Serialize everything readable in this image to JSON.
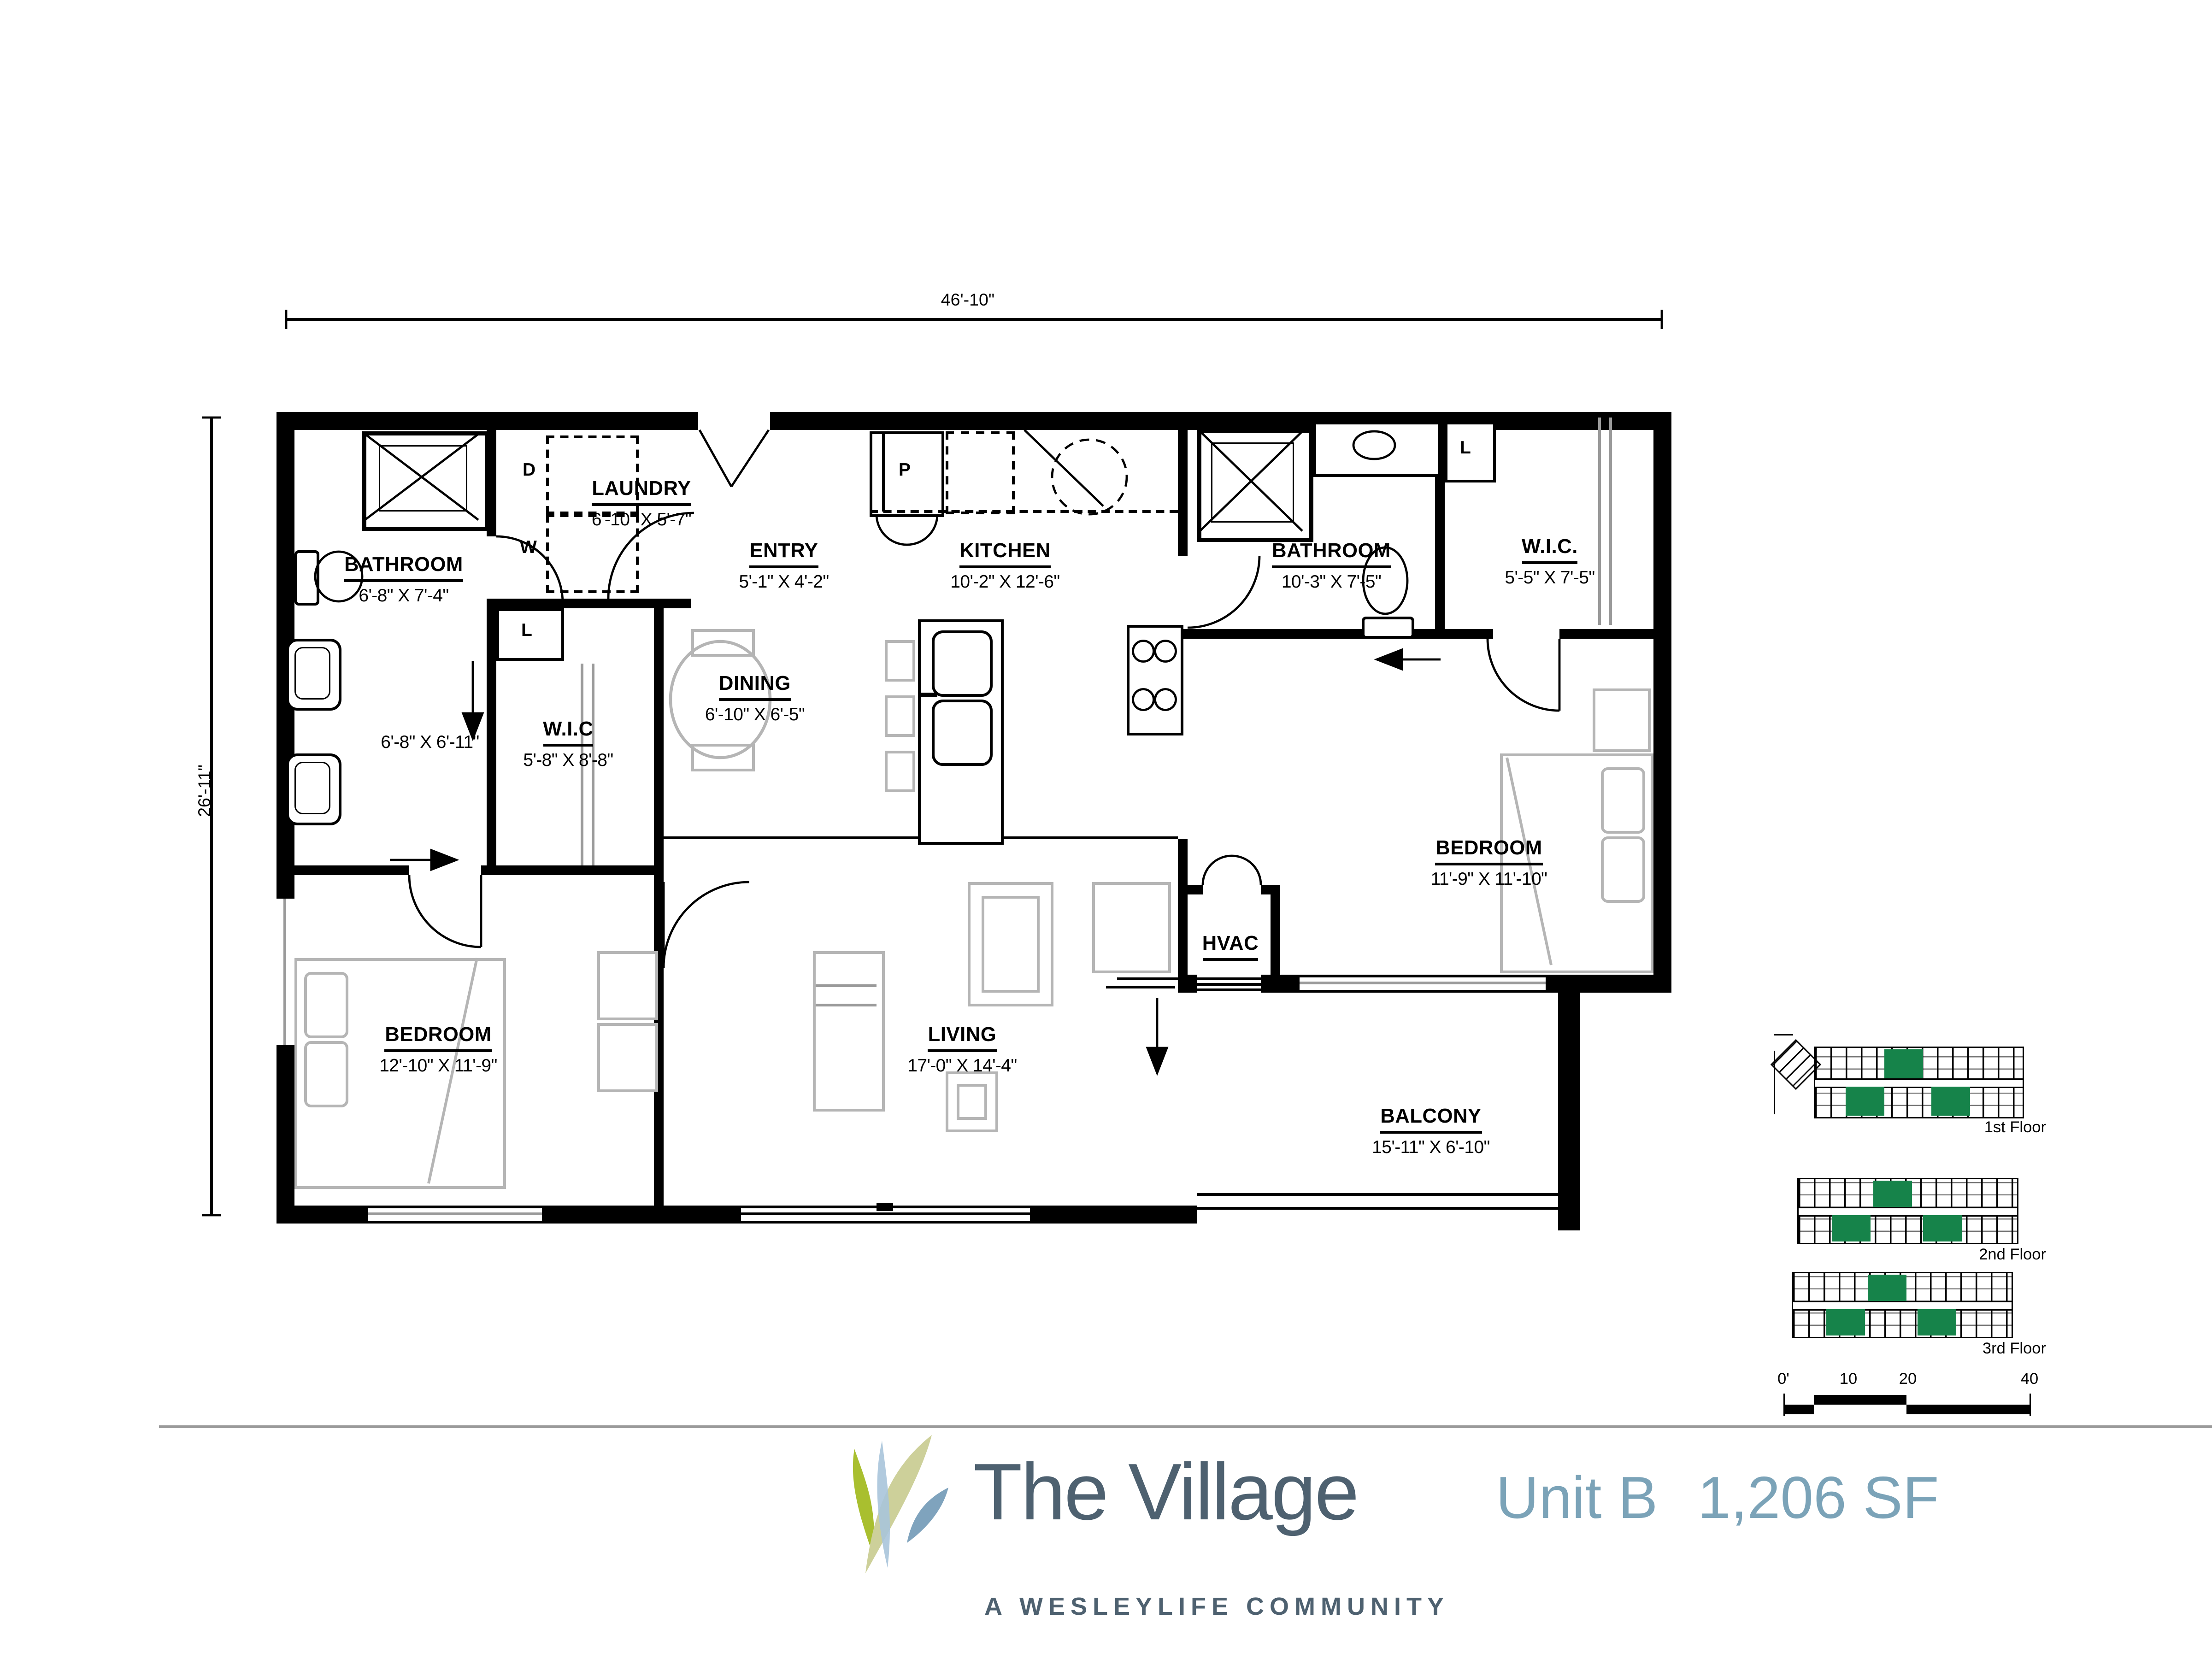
{
  "plan": {
    "overall_width_label": "46'-10\"",
    "overall_height_label": "26'-11\"",
    "rooms": [
      {
        "id": "bathroom-1",
        "name": "BATHROOM",
        "dims": "6'-8\" X 7'-4\""
      },
      {
        "id": "laundry",
        "name": "LAUNDRY",
        "dims": "6'-10\" X 5'-7\""
      },
      {
        "id": "entry",
        "name": "ENTRY",
        "dims": "5'-1\" X 4'-2\""
      },
      {
        "id": "kitchen",
        "name": "KITCHEN",
        "dims": "10'-2\" X 12'-6\""
      },
      {
        "id": "bathroom-2",
        "name": "BATHROOM",
        "dims": "10'-3\" X 7'-5\""
      },
      {
        "id": "wic-2",
        "name": "W.I.C.",
        "dims": "5'-5\" X 7'-5\""
      },
      {
        "id": "dining",
        "name": "DINING",
        "dims": "6'-10\" X 6'-5\""
      },
      {
        "id": "vanity-hall",
        "name": "",
        "dims": "6'-8\" X 6'-11\""
      },
      {
        "id": "wic-1",
        "name": "W.I.C",
        "dims": "5'-8\" X 8'-8\""
      },
      {
        "id": "bedroom-2",
        "name": "BEDROOM",
        "dims": "11'-9\" X 11'-10\""
      },
      {
        "id": "hvac",
        "name": "HVAC",
        "dims": ""
      },
      {
        "id": "bedroom-1",
        "name": "BEDROOM",
        "dims": "12'-10\" X 11'-9\""
      },
      {
        "id": "living",
        "name": "LIVING",
        "dims": "17'-0\" X 14'-4\""
      },
      {
        "id": "balcony",
        "name": "BALCONY",
        "dims": "15'-11\" X 6'-10\""
      }
    ],
    "fixture_labels": {
      "dryer": "D",
      "washer": "W",
      "linen_1": "L",
      "pantry": "P",
      "linen_2": "L"
    }
  },
  "key_plan": {
    "floors": [
      {
        "label": "1st Floor"
      },
      {
        "label": "2nd Floor"
      },
      {
        "label": "3rd Floor"
      }
    ],
    "highlight_color": "#16834a"
  },
  "scale_bar": {
    "labels": [
      "0'",
      "10",
      "20",
      "40"
    ]
  },
  "brand": {
    "name": "The Village",
    "tagline": "A WESLEYLIFE COMMUNITY",
    "unit": "Unit B",
    "area": "1,206 SF",
    "text_color": "#4e6170",
    "accent_color": "#7ba3b8",
    "grass_colors": [
      "#a9bf2f",
      "#cdd09a",
      "#a9c4da",
      "#7fa3bd"
    ]
  }
}
